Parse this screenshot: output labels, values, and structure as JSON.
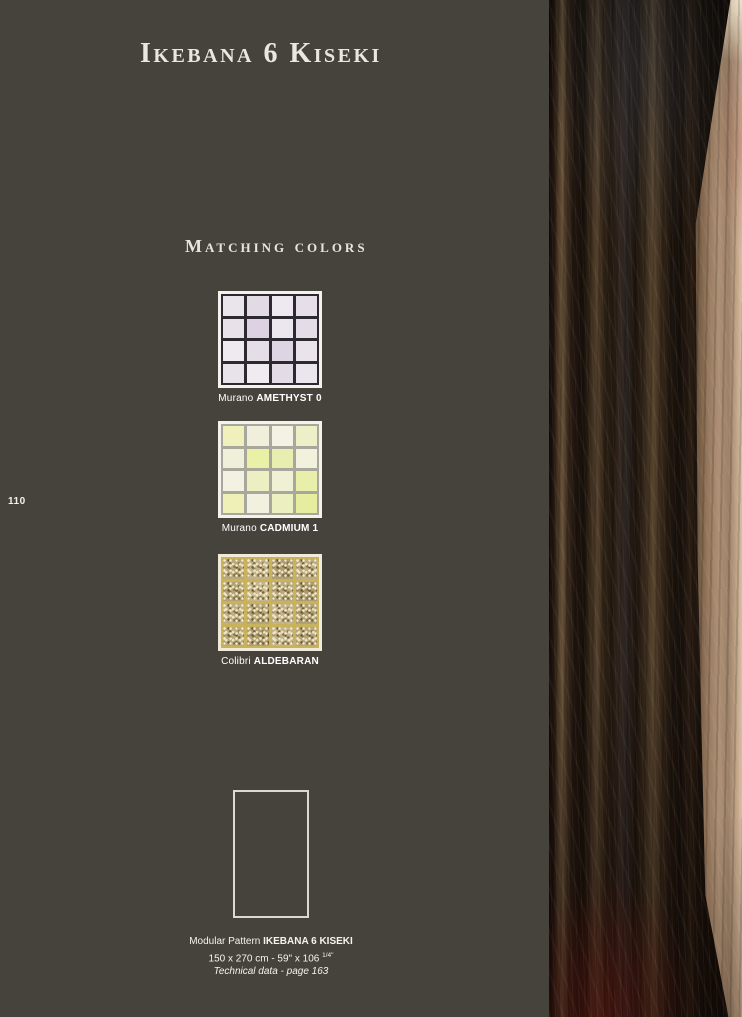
{
  "page": {
    "title": "Ikebana 6 Kiseki",
    "section_heading": "Matching colors",
    "page_number": "110",
    "background_color": "#46433c",
    "text_color": "#f0eee6"
  },
  "swatches": [
    {
      "brand": "Murano",
      "name": "AMETHYST 0",
      "grout": "#2d2930",
      "border": "#f4f2ec",
      "textured": false,
      "tiles": [
        "#eae4eb",
        "#e2dae5",
        "#eee9f0",
        "#e6dfe9",
        "#e8e1ea",
        "#dcd2e1",
        "#ece6ee",
        "#e4dce7",
        "#efe9f0",
        "#e5dee8",
        "#ded5e3",
        "#eae3ec",
        "#e8e2ea",
        "#f0eaf1",
        "#e3dbe6",
        "#ebe5ed"
      ]
    },
    {
      "brand": "Murano",
      "name": "CADMIUM 1",
      "grout": "#a8a79b",
      "border": "#f4f2ec",
      "textured": false,
      "tiles": [
        "#eff0bc",
        "#f1efdc",
        "#f3f2e3",
        "#edf0c6",
        "#f0efd9",
        "#eaf0a6",
        "#e7eeb0",
        "#f2f1de",
        "#f3f1e1",
        "#edefc2",
        "#f0f0d5",
        "#e9efaa",
        "#eef0b8",
        "#f2f0de",
        "#ecefc0",
        "#e6ed9e"
      ]
    },
    {
      "brand": "Colibri",
      "name": "ALDEBARAN",
      "grout": "#c9b25e",
      "border": "#f0ead8",
      "textured": true,
      "tiles": [
        "#b6a678",
        "#c1b186",
        "#ac9c6e",
        "#bcab7e",
        "#b1a173",
        "#c6b68b",
        "#b8a87a",
        "#ab9b6d",
        "#bfae82",
        "#b3a375",
        "#c3b288",
        "#af9f71",
        "#b9a97b",
        "#ae9e70",
        "#c4b389",
        "#b5a577"
      ]
    }
  ],
  "modular_pattern": {
    "label_regular": "Modular Pattern ",
    "label_bold": "IKEBANA 6 KISEKI",
    "dimensions": "150 x 270 cm - 59\" x 106 ",
    "dimensions_sup": "1/4\"",
    "technical": "Technical data - page 163"
  }
}
